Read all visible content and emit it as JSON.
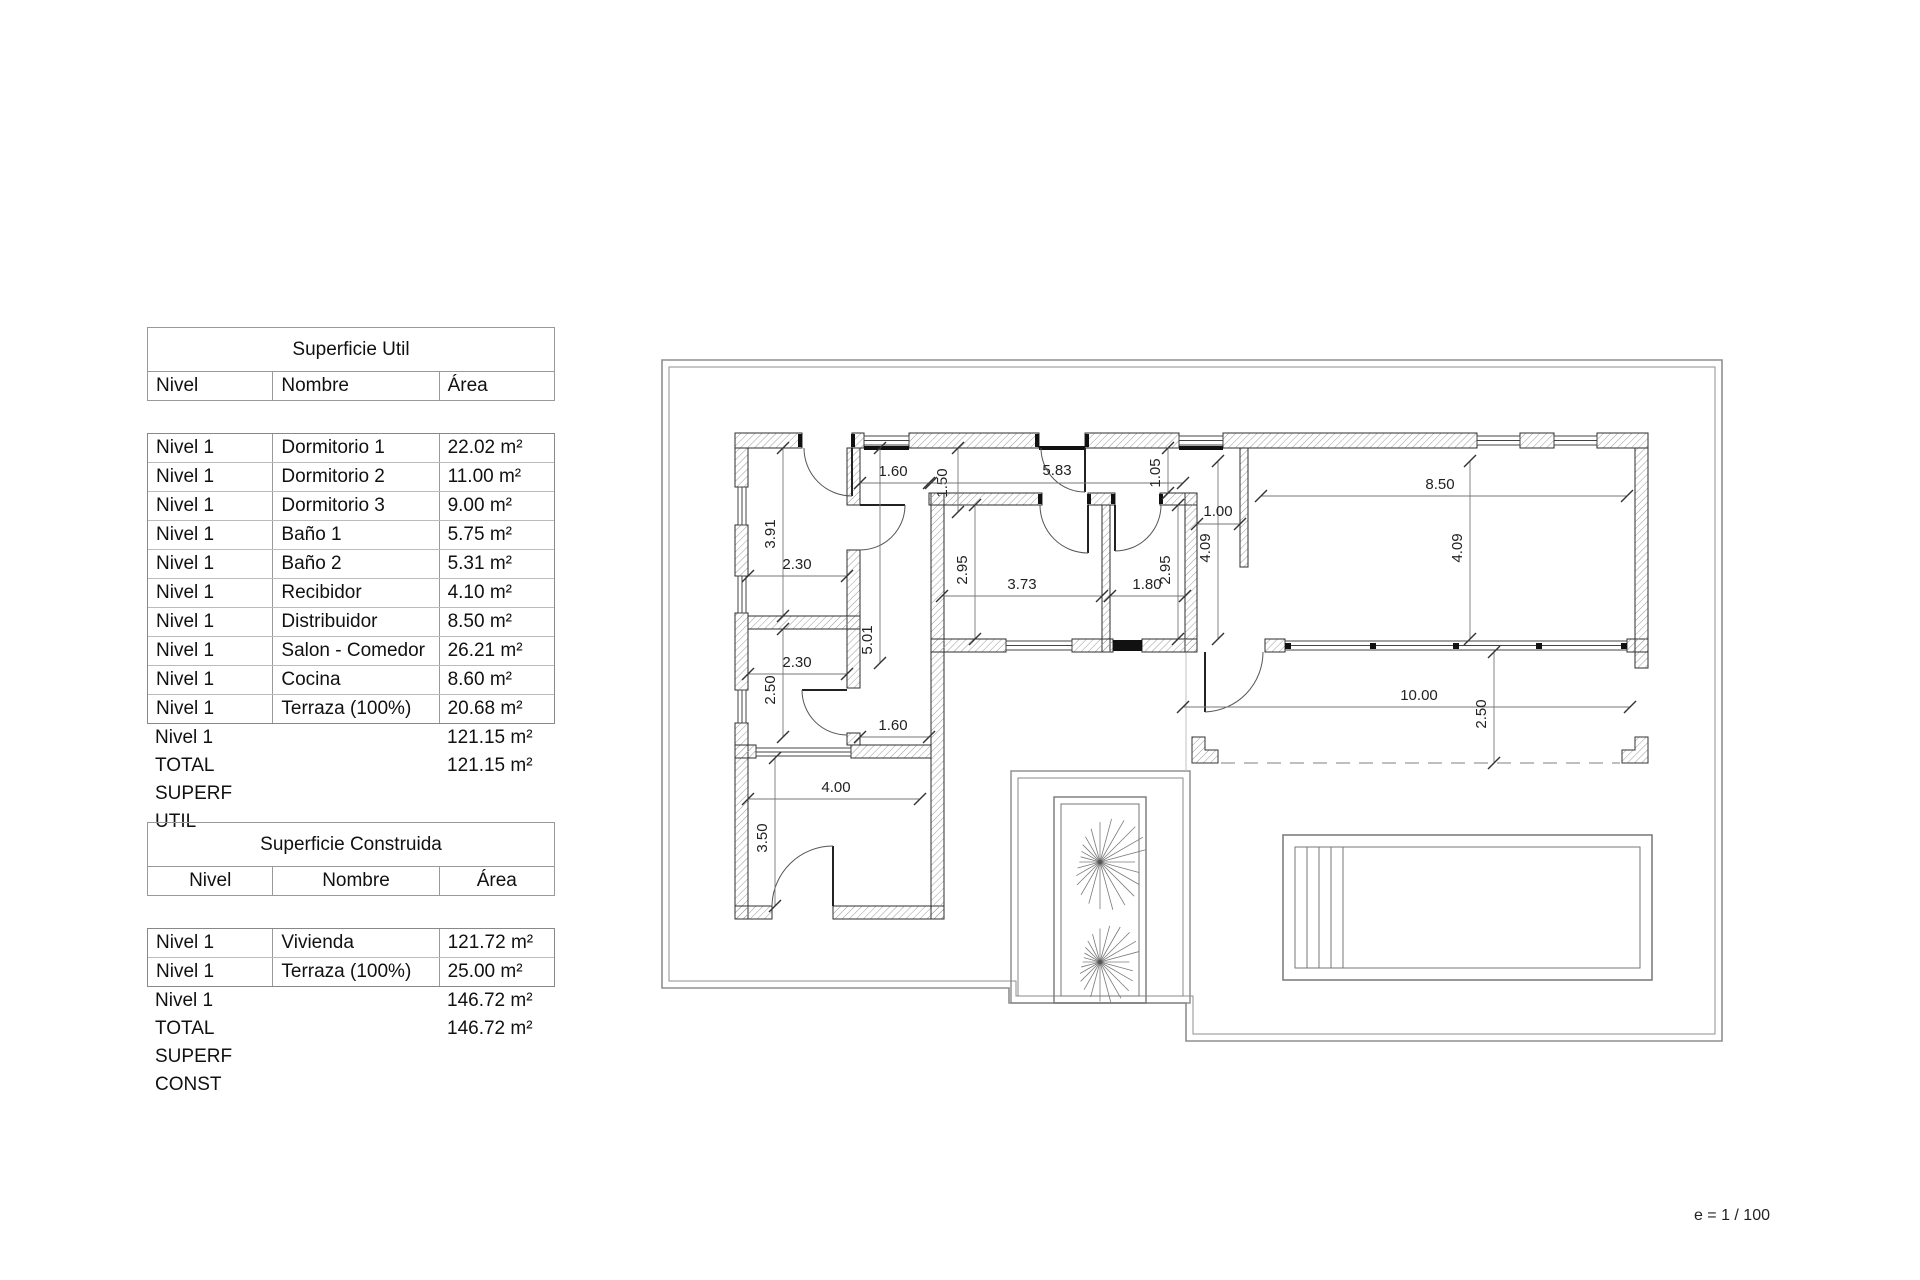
{
  "tables": {
    "util": {
      "title": "Superficie Util",
      "headers": [
        "Nivel",
        "Nombre",
        "Área"
      ],
      "rows": [
        {
          "nivel": "Nivel 1",
          "nombre": "Dormitorio 1",
          "area": "22.02 m²"
        },
        {
          "nivel": "Nivel 1",
          "nombre": "Dormitorio 2",
          "area": "11.00 m²"
        },
        {
          "nivel": "Nivel 1",
          "nombre": "Dormitorio 3",
          "area": "9.00 m²"
        },
        {
          "nivel": "Nivel 1",
          "nombre": "Baño 1",
          "area": "5.75 m²"
        },
        {
          "nivel": "Nivel 1",
          "nombre": "Baño 2",
          "area": "5.31 m²"
        },
        {
          "nivel": "Nivel 1",
          "nombre": "Recibidor",
          "area": "4.10 m²"
        },
        {
          "nivel": "Nivel 1",
          "nombre": "Distribuidor",
          "area": "8.50 m²"
        },
        {
          "nivel": "Nivel 1",
          "nombre": "Salon - Comedor",
          "area": "26.21 m²"
        },
        {
          "nivel": "Nivel 1",
          "nombre": "Cocina",
          "area": "8.60 m²"
        },
        {
          "nivel": "Nivel 1",
          "nombre": "Terraza (100%)",
          "area": "20.68 m²"
        }
      ],
      "subtotal": {
        "nivel": "Nivel 1",
        "nombre": "",
        "area": "121.15 m²"
      },
      "total": {
        "nivel": "TOTAL SUPERF UTIL",
        "nombre": "",
        "area": "121.15 m²"
      }
    },
    "construida": {
      "title": "Superficie Construida",
      "headers": [
        "Nivel",
        "Nombre",
        "Área"
      ],
      "rows": [
        {
          "nivel": "Nivel 1",
          "nombre": "Vivienda",
          "area": "121.72 m²"
        },
        {
          "nivel": "Nivel 1",
          "nombre": "Terraza (100%)",
          "area": "25.00 m²"
        }
      ],
      "subtotal": {
        "nivel": "Nivel 1",
        "nombre": "",
        "area": "146.72 m²"
      },
      "total": {
        "nivel": "TOTAL SUPERF CONST",
        "nombre": "",
        "area": "146.72 m²"
      }
    }
  },
  "plan": {
    "dimensions": [
      "1.60",
      "1.50",
      "5.83",
      "1.05",
      "8.50",
      "3.91",
      "2.30",
      "2.95",
      "3.73",
      "1.80",
      "2.95",
      "4.09",
      "1.00",
      "4.09",
      "5.01",
      "2.30",
      "2.50",
      "1.60",
      "4.00",
      "3.50",
      "10.00",
      "2.50"
    ],
    "scale_note": "e = 1 / 100"
  }
}
